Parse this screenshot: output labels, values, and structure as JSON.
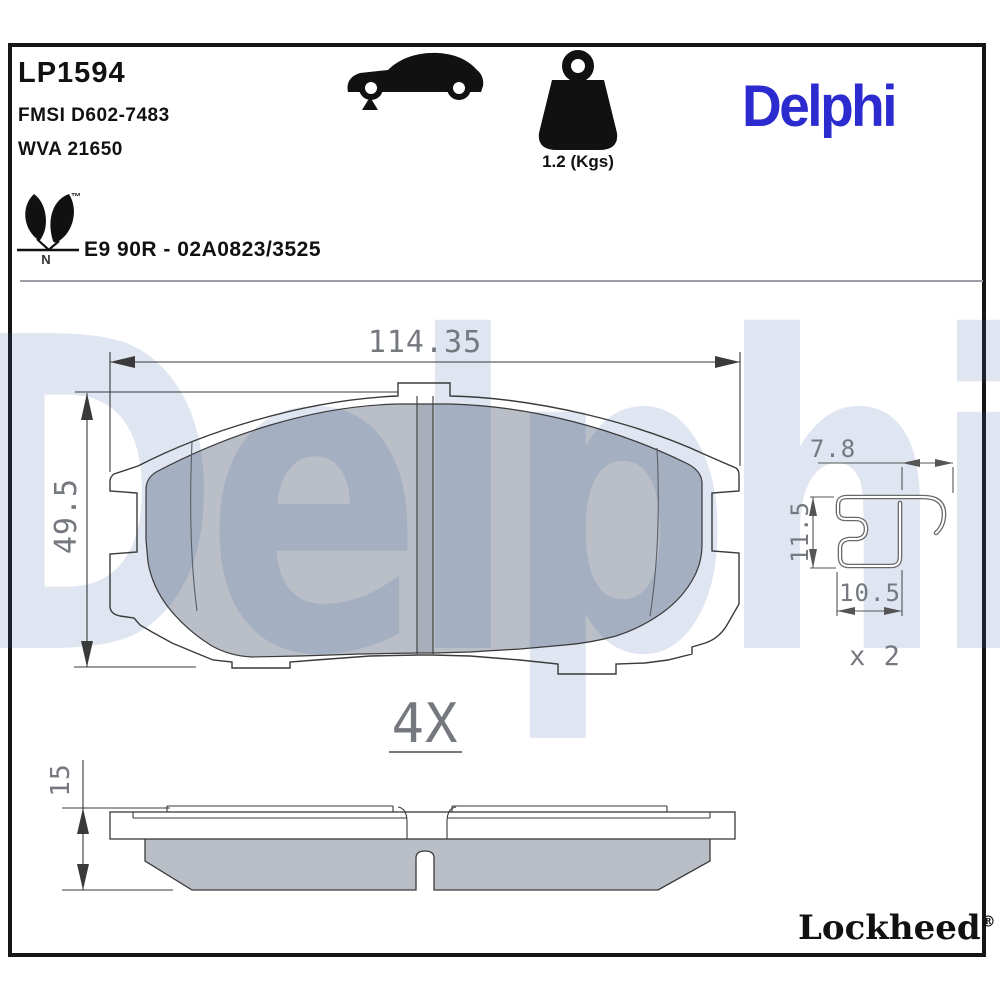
{
  "header": {
    "part_number": "LP1594",
    "fmsi": "FMSI D602-7483",
    "wva": "WVA 21650",
    "weight": "1.2 (Kgs)",
    "homologation": "E9 90R - 02A0823/3525",
    "eco_letter": "N",
    "trademark": "™"
  },
  "brand": {
    "logo": "Delphi",
    "watermark": "Delphi",
    "footer_logo": "Lockheed",
    "registered": "®"
  },
  "dimensions": {
    "front_width": "114.35",
    "front_height": "49.5",
    "thickness": "15",
    "pad_quantity": "4X",
    "clip_top": "7.8",
    "clip_height": "11.5",
    "clip_bottom": "10.5",
    "clip_quantity": "x 2"
  },
  "colors": {
    "delphi_blue": "#2b2bd0",
    "watermark_blue": "#3d62a8",
    "pad_gray": "#b9bec7",
    "slot_gray": "#a9aebb",
    "line_dark": "#3a3a3a",
    "dim_text": "#75797f"
  }
}
